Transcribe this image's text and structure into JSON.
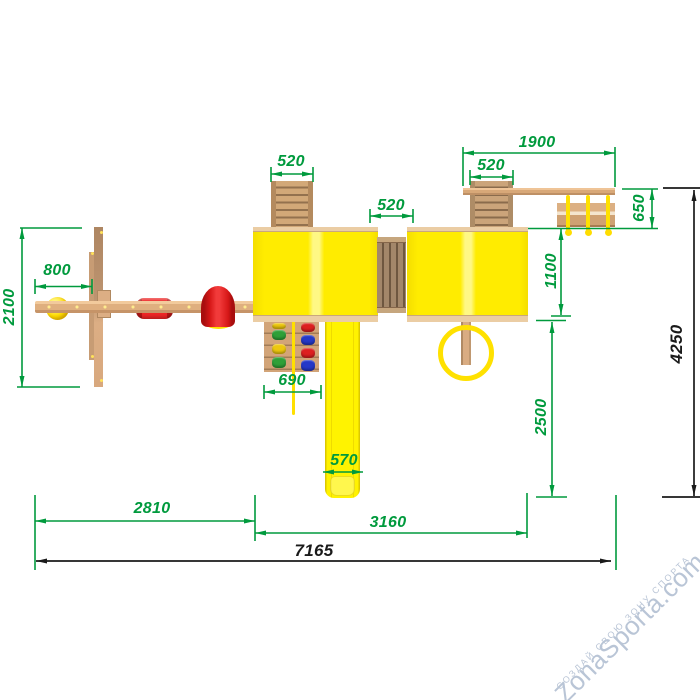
{
  "title": "Playground complex — top view dimensioned drawing",
  "dims": {
    "ladder_width": "520",
    "bridge_width": "520",
    "climber_width": "520",
    "cantilever_span": "1900",
    "bench_depth": "650",
    "roof_to_bench": "1100",
    "roof_to_slide_end": "2500",
    "aframe_depth": "2100",
    "ball_offset": "800",
    "climb_wall_width": "690",
    "slide_width": "570",
    "swing_section_width": "2810",
    "tower_section_width": "3160",
    "total_width": "7165",
    "total_depth": "4250"
  },
  "watermark": {
    "brand": "ZonaSporta.com",
    "tagline": "СОЗДАЙ СВОЮ ЗОНУ СПОРТА"
  },
  "colors": {
    "dimension_green": "#009A3D",
    "dimension_black": "#1A1A1A",
    "roof_yellow": "#FFEC00",
    "wood_tan": "#D8A878",
    "plastic_red": "#E81A1A",
    "watermark_blue_gray": "#B6C2D4"
  }
}
